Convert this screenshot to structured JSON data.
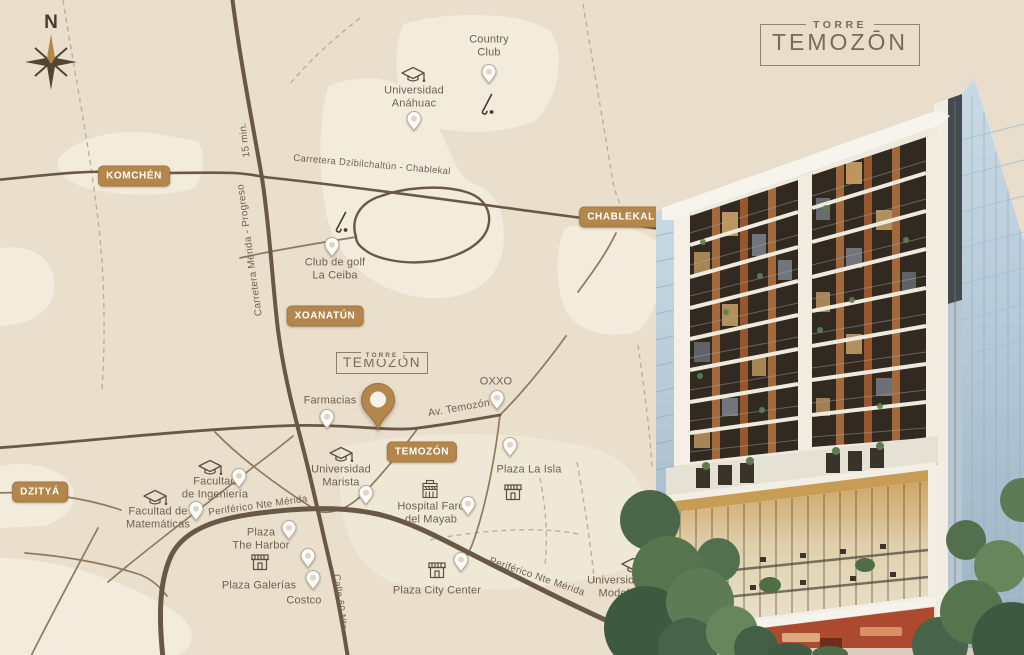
{
  "page": {
    "title": "Torre Temozón — mapa de ubicación"
  },
  "brand": {
    "top": "TORRE",
    "name": "TEMOZŌN"
  },
  "compass": {
    "north": "N"
  },
  "colors": {
    "map_bg": "#e9dfcc",
    "land_patch": "#f3ecdc",
    "road_dark": "#6a5847",
    "badge_bg": "#b3874b",
    "badge_text": "#ffffff",
    "label_text": "#6f6152",
    "logo_text": "#7b6a58",
    "pin_gold": "#b3874b",
    "glass_blue": "#b5cbd9",
    "wood_accent": "#a2693c",
    "storefront_red": "#ab4a2e"
  },
  "map": {
    "badges": [
      {
        "id": "komchen",
        "label": "KOMCHÉN"
      },
      {
        "id": "chablekal",
        "label": "CHABLEKAL"
      },
      {
        "id": "xoanatun",
        "label": "XOANATÚN"
      },
      {
        "id": "dzitya",
        "label": "DZITYÁ"
      },
      {
        "id": "temozon",
        "label": "TEMOZÓN"
      }
    ],
    "roads": [
      {
        "id": "min15",
        "label": "15 min."
      },
      {
        "id": "merida-progreso",
        "label": "Carretera Mérida - Progreso"
      },
      {
        "id": "dzibilchaltun",
        "label": "Carretera Dzibilchaltún - Chablekal"
      },
      {
        "id": "av-temozon",
        "label": "Av. Temozón"
      },
      {
        "id": "periferico-oeste",
        "label": "Periférico Nte Mérida"
      },
      {
        "id": "periferico-este",
        "label": "Periférico Nte Mérida"
      },
      {
        "id": "calle-60",
        "label": "Calle 60 Nte"
      }
    ],
    "pois": [
      {
        "id": "country-club",
        "label": "Country\nClub",
        "icon": "golf"
      },
      {
        "id": "universidad-anahuac",
        "label": "Universidad\nAnáhuac",
        "icon": "grad"
      },
      {
        "id": "club-golf-la-ceiba",
        "label": "Club de golf\nLa Ceiba",
        "icon": "golf"
      },
      {
        "id": "farmacias",
        "label": "Farmacias",
        "icon": "none"
      },
      {
        "id": "oxxo",
        "label": "OXXO",
        "icon": "none"
      },
      {
        "id": "universidad-marista",
        "label": "Universidad\nMarista",
        "icon": "grad"
      },
      {
        "id": "plaza-la-isla",
        "label": "Plaza La Isla",
        "icon": "shop"
      },
      {
        "id": "hospital-faro",
        "label": "Hospital Faro\ndel Mayab",
        "icon": "hospital"
      },
      {
        "id": "facultad-ingenieria",
        "label": "Facultad\nde Ingeniería",
        "icon": "grad"
      },
      {
        "id": "facultad-matematicas",
        "label": "Facultad de\nMatemáticas",
        "icon": "grad"
      },
      {
        "id": "plaza-the-harbor",
        "label": "Plaza\nThe Harbor",
        "icon": "none"
      },
      {
        "id": "plaza-galerias",
        "label": "Plaza Galerías",
        "icon": "shop"
      },
      {
        "id": "costco",
        "label": "Costco",
        "icon": "none"
      },
      {
        "id": "plaza-city-center",
        "label": "Plaza City Center",
        "icon": "shop"
      },
      {
        "id": "universidad-modelo",
        "label": "Universidad\nModelo",
        "icon": "grad"
      }
    ]
  }
}
